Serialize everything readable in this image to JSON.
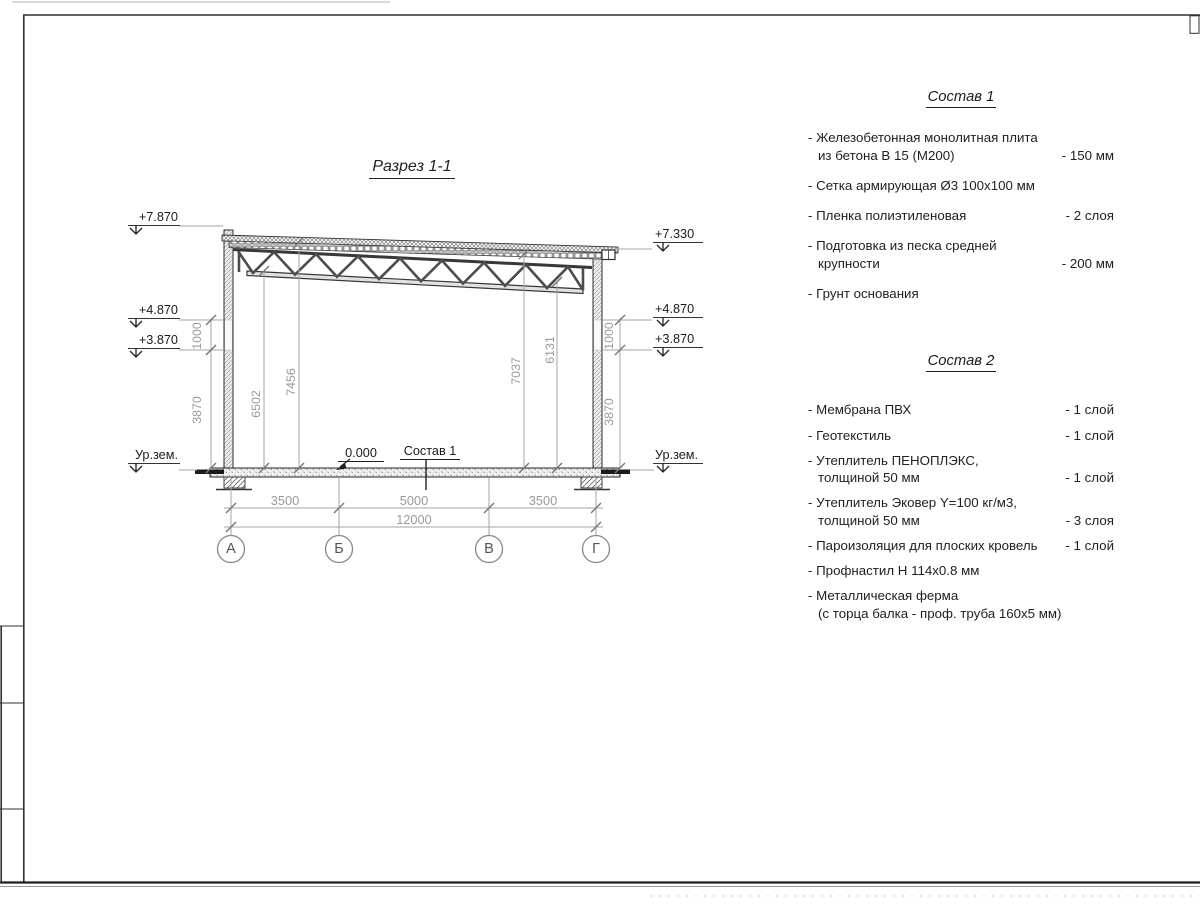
{
  "section": {
    "title": "Разрез 1-1",
    "marks": {
      "left": [
        "+7.870",
        "+4.870",
        "+3.870",
        "Ур.зем."
      ],
      "right": [
        "+7.330",
        "+4.870",
        "+3.870",
        "Ур.зем."
      ]
    },
    "zero_mark": "0.000",
    "floor_callout": "Состав 1",
    "dims": {
      "left_1000": "1000",
      "left_3870": "3870",
      "right_1000": "1000",
      "right_3870": "3870",
      "int_6502": "6502",
      "int_7456": "7456",
      "int_7037": "7037",
      "int_6131": "6131",
      "span_ab": "3500",
      "span_bv": "5000",
      "span_vg": "3500",
      "total": "12000"
    },
    "axes": [
      "А",
      "Б",
      "В",
      "Г"
    ]
  },
  "composition1": {
    "title": "Состав 1",
    "items": [
      {
        "label": "- Железобетонная  монолитная плита\nиз бетона В 15 (М200)",
        "value": "- 150 мм"
      },
      {
        "label": "- Сетка армирующая Ø3 100x100 мм",
        "value": ""
      },
      {
        "label": "- Пленка полиэтиленовая",
        "value": "-  2 слоя"
      },
      {
        "label": "- Подготовка из песка средней\nкрупности",
        "value": "- 200 мм"
      },
      {
        "label": "- Грунт основания",
        "value": ""
      }
    ]
  },
  "composition2": {
    "title": "Состав 2",
    "items": [
      {
        "label": "- Мембрана ПВХ",
        "value": "- 1 слой"
      },
      {
        "label": "- Геотекстиль",
        "value": "- 1 слой"
      },
      {
        "label": "- Утеплитель ПЕНОПЛЭКС,\nтолщиной 50 мм",
        "value": "- 1 слой"
      },
      {
        "label": "- Утеплитель Эковер Y=100 кг/м3,\nтолщиной 50 мм",
        "value": "- 3 слоя"
      },
      {
        "label": "- Пароизоляция для плоских кровель",
        "value": "- 1 слой"
      },
      {
        "label": "- Профнастил Н 114x0.8 мм",
        "value": ""
      },
      {
        "label": "- Металлическая ферма\n(с торца балка - проф. труба 160x5 мм)",
        "value": ""
      }
    ]
  }
}
